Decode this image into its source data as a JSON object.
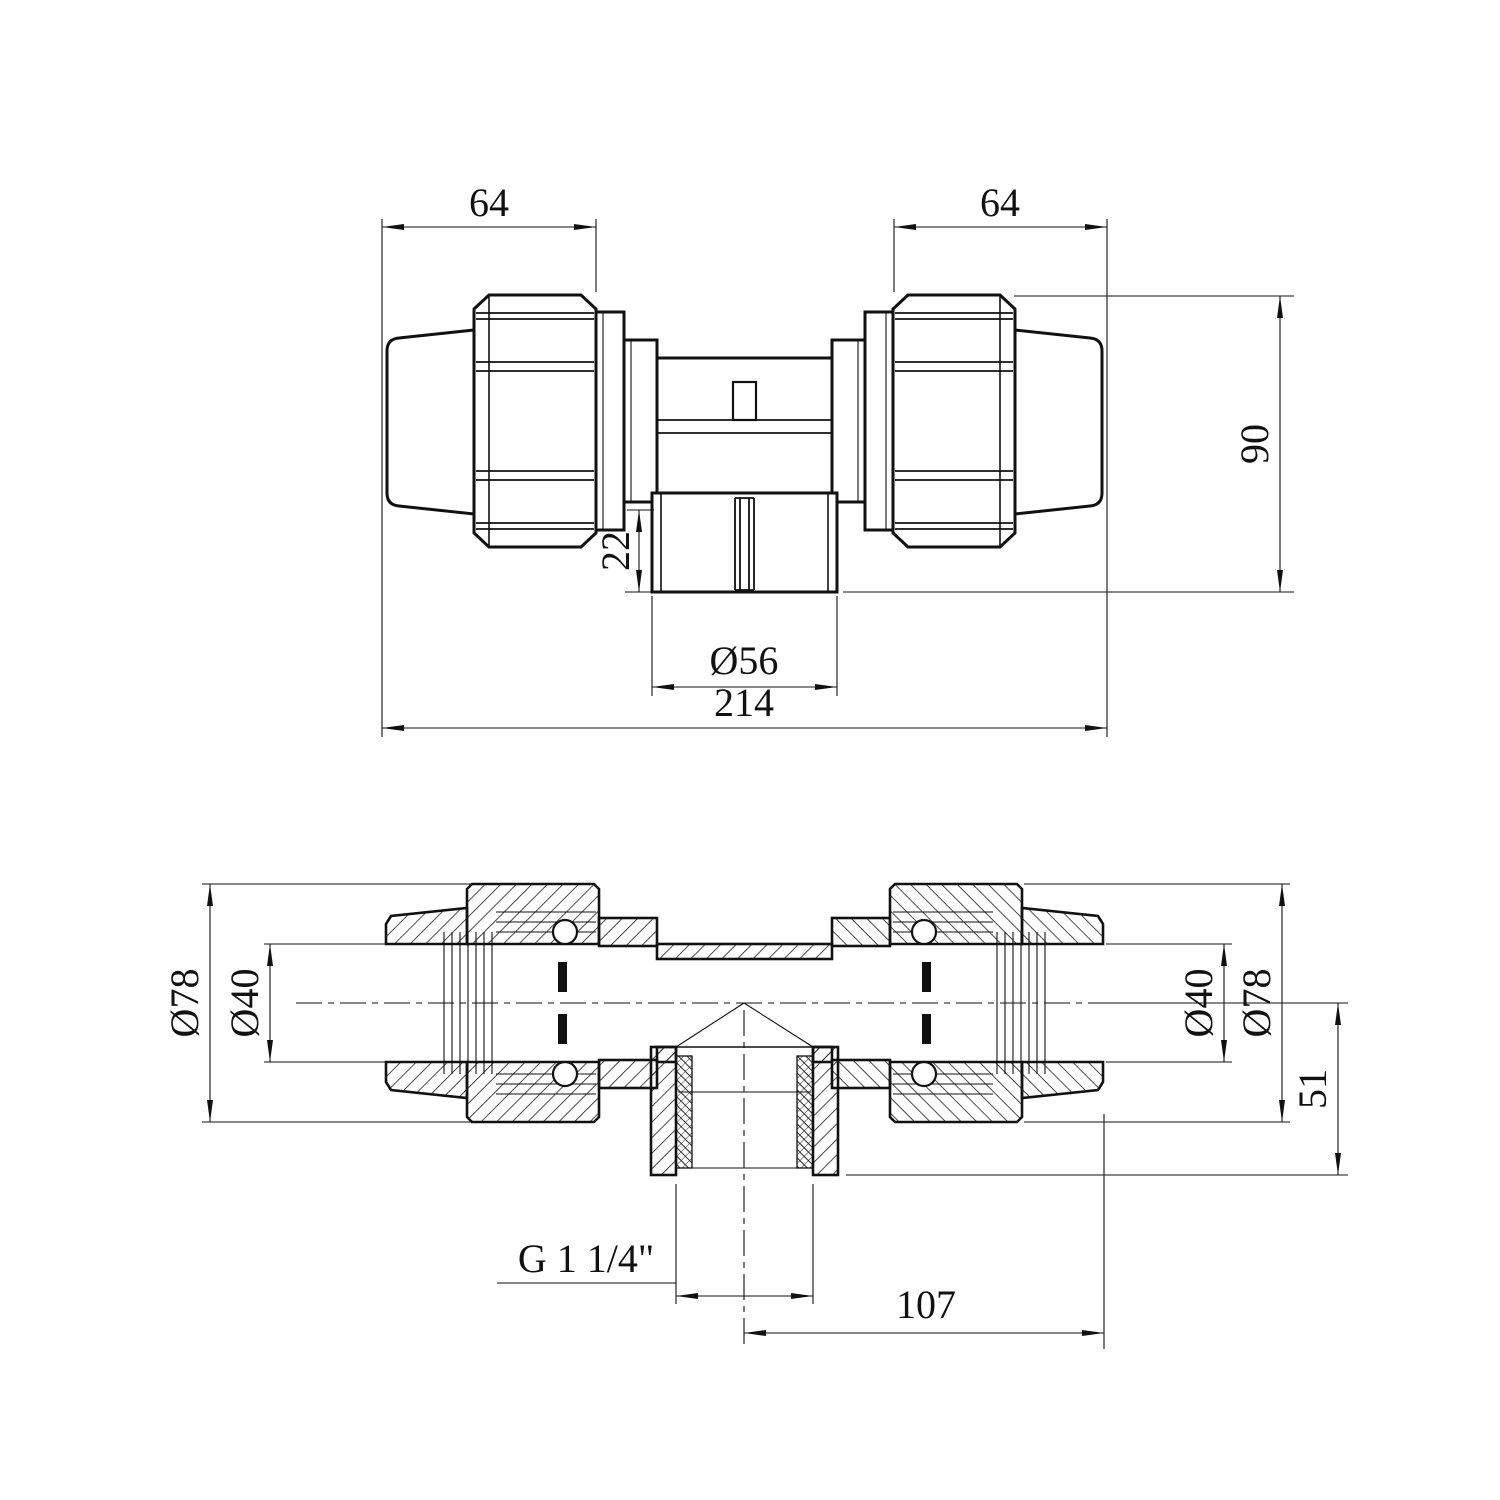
{
  "colors": {
    "line": "#111111",
    "background": "#ffffff"
  },
  "top_view": {
    "dim_left_nut_width": "64",
    "dim_right_nut_width": "64",
    "dim_overall_height": "90",
    "dim_branch_stub": "22",
    "dim_branch_outer_dia": "Ø56",
    "dim_overall_length": "214"
  },
  "section_view": {
    "dim_left_outer_dia": "Ø78",
    "dim_left_bore_dia": "Ø40",
    "dim_right_bore_dia": "Ø40",
    "dim_right_outer_dia": "Ø78",
    "dim_branch_depth": "51",
    "thread_label": "G 1 1/4\"",
    "dim_center_to_end": "107"
  }
}
